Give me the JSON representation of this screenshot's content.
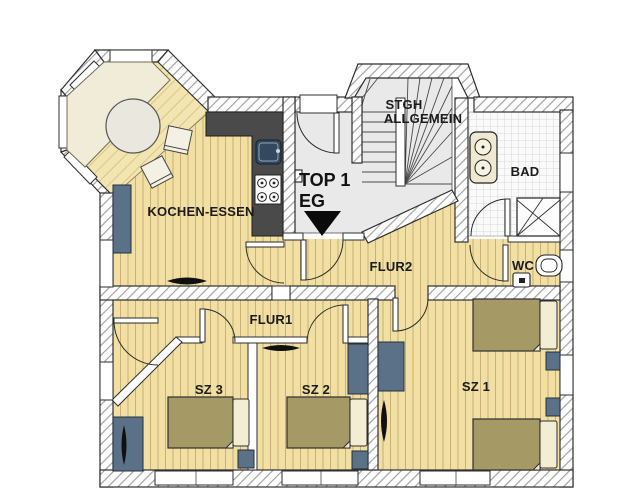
{
  "plan": {
    "title": "Floor plan TOP 1 EG",
    "unit_label": "TOP 1",
    "floor_label": "EG",
    "rooms": {
      "kitchen": "KOCHEN-ESSEN",
      "stairwell_line1": "STGH",
      "stairwell_line2": "ALLGEMEIN",
      "bath": "BAD",
      "wc": "WC",
      "hall2": "FLUR2",
      "hall1": "FLUR1",
      "bedroom3": "SZ 3",
      "bedroom2": "SZ 2",
      "bedroom1": "SZ 1"
    },
    "colors": {
      "wood_floor": "#F1DFA3",
      "wood_stripe": "#C9B176",
      "bay_floor": "#F3E5B2",
      "common_floor": "#E9E9E9",
      "tile_floor": "#FAFAFA",
      "wall_outline": "#2e2e2e",
      "counter_dark": "#4A4A4A",
      "sink_navy": "#35495E",
      "furniture_blue": "#5B7187",
      "bed_brown": "#A59966",
      "pillow_cream": "#F3EDD3",
      "label_ink": "#1b1b1b"
    }
  }
}
